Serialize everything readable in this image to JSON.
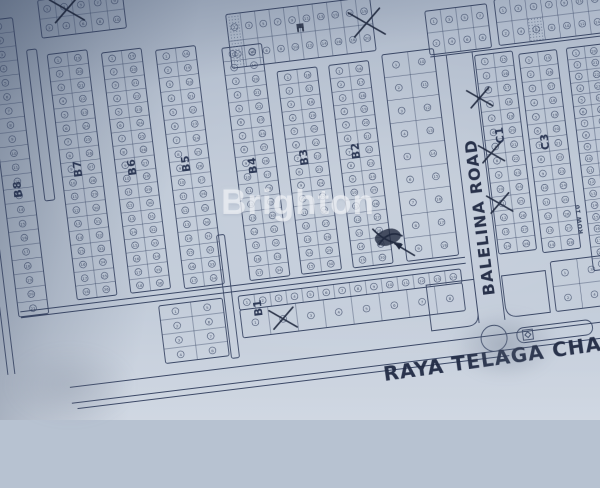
{
  "watermark": "Brighton",
  "meta": {
    "type": "photographed blueprint housing site plan",
    "plot_numbering": "sequential circled lot numbers (illegible at photo scale)"
  },
  "colors": {
    "paper": "#bfc9d7",
    "paper_shadow": "#aeb9ca",
    "ink": "#33405f",
    "pen": "#141d33",
    "watermark": "rgba(255,255,255,0.52)"
  },
  "streets": {
    "bottom": "RAYA TELAGA CHAMA",
    "vertical": "BALELINA ROAD",
    "row_label": "ROW 10"
  },
  "plan": {
    "rotation_deg": -7,
    "blocks": [
      {
        "id": "B8",
        "x": 38,
        "y": 14,
        "w": 30,
        "h": 298,
        "cols": 1,
        "rows": 21
      },
      {
        "id": "channel-1",
        "x": 78,
        "y": 48,
        "w": 10,
        "h": 152,
        "style": "plain"
      },
      {
        "id": "B7",
        "x": 98,
        "y": 55,
        "w": 40,
        "h": 247,
        "cols": 2,
        "rows": 18
      },
      {
        "id": "B6",
        "x": 152,
        "y": 60,
        "w": 40,
        "h": 242,
        "cols": 2,
        "rows": 18
      },
      {
        "id": "B5",
        "x": 206,
        "y": 64,
        "w": 40,
        "h": 240,
        "cols": 2,
        "rows": 17
      },
      {
        "id": "B4",
        "x": 272,
        "y": 70,
        "w": 40,
        "h": 234,
        "cols": 2,
        "rows": 17
      },
      {
        "id": "B3",
        "x": 324,
        "y": 100,
        "w": 40,
        "h": 204,
        "cols": 2,
        "rows": 15
      },
      {
        "id": "B2",
        "x": 376,
        "y": 100,
        "w": 40,
        "h": 204,
        "cols": 2,
        "rows": 15
      },
      {
        "id": "mid-wide",
        "x": 430,
        "y": 96,
        "w": 52,
        "h": 208,
        "cols": 2,
        "rows": 9
      },
      {
        "id": "C1",
        "x": 522,
        "y": 108,
        "w": 38,
        "h": 200,
        "cols": 2,
        "rows": 14
      },
      {
        "id": "C3",
        "x": 566,
        "y": 112,
        "w": 38,
        "h": 200,
        "cols": 2,
        "rows": 14
      },
      {
        "id": "right-edge",
        "x": 614,
        "y": 112,
        "w": 36,
        "h": 224,
        "cols": 2,
        "rows": 19
      },
      {
        "id": "top-0",
        "x": 95,
        "y": 0,
        "w": 85,
        "h": 38,
        "cols": 5,
        "rows": 2
      },
      {
        "id": "top-1",
        "x": 280,
        "y": 37,
        "w": 145,
        "h": 54,
        "cols": 10,
        "rows": 2,
        "stipple_cells": [
          [
            0,
            0
          ],
          [
            0,
            1
          ]
        ]
      },
      {
        "id": "top-right-0",
        "x": 478,
        "y": 58,
        "w": 62,
        "h": 44,
        "cols": 4,
        "rows": 2
      },
      {
        "id": "top-right-1",
        "x": 548,
        "y": 55,
        "w": 108,
        "h": 46,
        "cols": 7,
        "rows": 2,
        "stipple_cells": [
          [
            2,
            1
          ]
        ]
      },
      {
        "id": "bottom-left",
        "x": 178,
        "y": 318,
        "w": 64,
        "h": 58,
        "cols": 2,
        "rows": 4
      },
      {
        "id": "channel-2",
        "x": 244,
        "y": 255,
        "w": 8,
        "h": 124,
        "style": "plain"
      },
      {
        "id": "B1-row-small",
        "x": 258,
        "y": 318,
        "w": 224,
        "h": 14,
        "cols": 14,
        "rows": 1
      },
      {
        "id": "B1-row-large",
        "x": 258,
        "y": 332,
        "w": 224,
        "h": 28,
        "cols": 8,
        "rows": 1
      },
      {
        "id": "corner-left",
        "x": 446,
        "y": 330,
        "w": 48,
        "h": 46,
        "style": "stipple-corner",
        "corner": "br"
      },
      {
        "id": "corner-right",
        "x": 522,
        "y": 330,
        "w": 44,
        "h": 42,
        "style": "stipple-corner",
        "corner": "bl"
      },
      {
        "id": "bottom-right",
        "x": 572,
        "y": 322,
        "w": 80,
        "h": 50,
        "cols": 3,
        "rows": 2
      }
    ],
    "labels": [
      {
        "text": "B8",
        "x": 56,
        "y": 185
      },
      {
        "text": "B7",
        "x": 118,
        "y": 172
      },
      {
        "text": "B6",
        "x": 172,
        "y": 177
      },
      {
        "text": "B5",
        "x": 226,
        "y": 180
      },
      {
        "text": "B4",
        "x": 292,
        "y": 190
      },
      {
        "text": "B3",
        "x": 344,
        "y": 188
      },
      {
        "text": "B2",
        "x": 396,
        "y": 188
      },
      {
        "text": "C1",
        "x": 541,
        "y": 190
      },
      {
        "text": "C3",
        "x": 585,
        "y": 202
      },
      {
        "text": "B1",
        "x": 280,
        "y": 332
      }
    ],
    "roads": [
      [
        20,
        8,
        20,
        368
      ],
      [
        27,
        8,
        27,
        368
      ],
      [
        80,
        388,
        654,
        388
      ],
      [
        80,
        404,
        654,
        404
      ],
      [
        85,
        410,
        520,
        410
      ],
      [
        494,
        104,
        494,
        374
      ],
      [
        520,
        104,
        520,
        374
      ],
      [
        40,
        307,
        488,
        307
      ],
      [
        40,
        313,
        488,
        313
      ],
      [
        478,
        104,
        652,
        104
      ]
    ],
    "roundabout": {
      "cx": 507,
      "cy": 391,
      "r": 13
    },
    "gate": {
      "x": 530,
      "y": 384,
      "w": 76,
      "h": 15
    },
    "handwriting": [
      {
        "bind": "bottom",
        "x": 393,
        "y": 420,
        "rot": -1,
        "fs": 20,
        "ls": 1
      },
      {
        "bind": "vertical",
        "x": 513,
        "y": 348,
        "rot": -90,
        "fs": 16,
        "ls": 1
      },
      {
        "bind": "row_label",
        "x": 608,
        "y": 298,
        "rot": -90,
        "fs": 6,
        "ls": 0.5,
        "printed": true
      }
    ],
    "annotations": {
      "x_marks": [
        [
          123,
          13,
          16
        ],
        [
          419,
          63,
          17
        ],
        [
          522,
          151,
          12
        ],
        [
          527,
          207,
          12
        ],
        [
          529,
          258,
          12
        ],
        [
          300,
          346,
          13
        ]
      ],
      "scribble": {
        "x": 418,
        "y": 281
      },
      "symbol": {
        "x": 352,
        "y": 57
      }
    }
  }
}
